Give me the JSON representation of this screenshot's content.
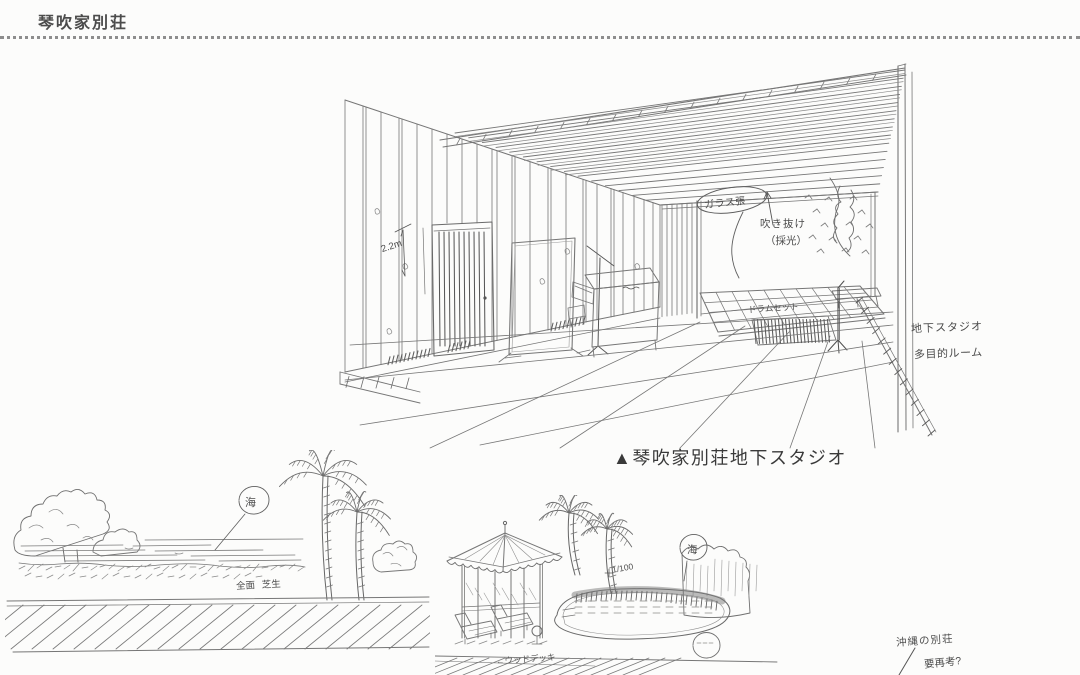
{
  "header": {
    "title": "琴吹家別荘"
  },
  "studio": {
    "caption": "▲琴吹家別荘地下スタジオ",
    "notes": {
      "glass": "ガラス張",
      "skylight_1": "吹き抜け",
      "skylight_2": "（採光）",
      "ceiling_height": "2.2m",
      "drum_set": "ドラムセット",
      "basement_1": "地下スタジオ",
      "basement_2": "多目的ルーム"
    }
  },
  "beach": {
    "sea": "海",
    "lawn": "全面 芝生"
  },
  "pool": {
    "sea": "海",
    "scale": "1/100",
    "deck": "←ウッドデッキ"
  },
  "margin_note": {
    "line1": "沖縄の別荘",
    "line2": "要再考?"
  }
}
